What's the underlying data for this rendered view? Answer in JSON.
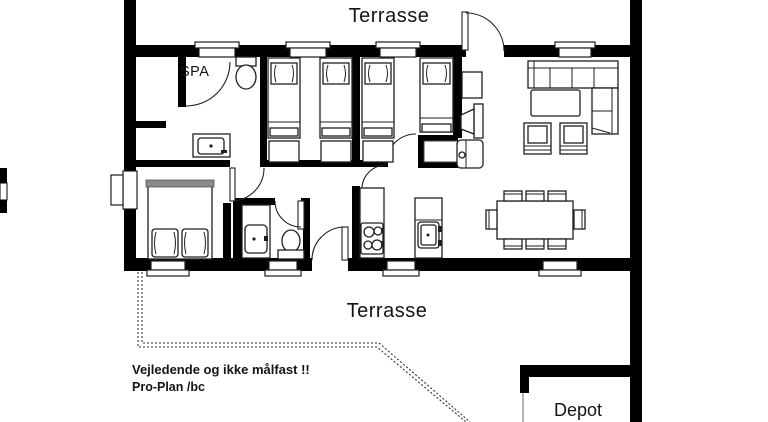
{
  "title": "Floor plan drawing",
  "labels": {
    "terrace_top": "Terrasse",
    "terrace_bottom": "Terrasse",
    "spa": "SPA",
    "depot": "Depot",
    "disclaimer_line1": "Vejledende og ikke målfast !!",
    "disclaimer_line2": "Pro-Plan /bc"
  },
  "colors": {
    "wall": "#000000",
    "background": "#ffffff",
    "furniture_outline": "#1f1f1f",
    "text": "#141414",
    "dotted_boundary": "#333333",
    "gray_accent": "#8a8a8a"
  },
  "icons": [
    "single-bed-icon",
    "double-bed-icon",
    "toilet-icon",
    "washbasin-icon",
    "sink-icon",
    "cooktop-icon",
    "corner-sofa-icon",
    "coffee-table-icon",
    "armchair-icon",
    "tv-icon",
    "wood-stove-icon",
    "chimney-icon",
    "dining-table-icon",
    "chair-icon",
    "window-icon",
    "door-swing-icon"
  ]
}
